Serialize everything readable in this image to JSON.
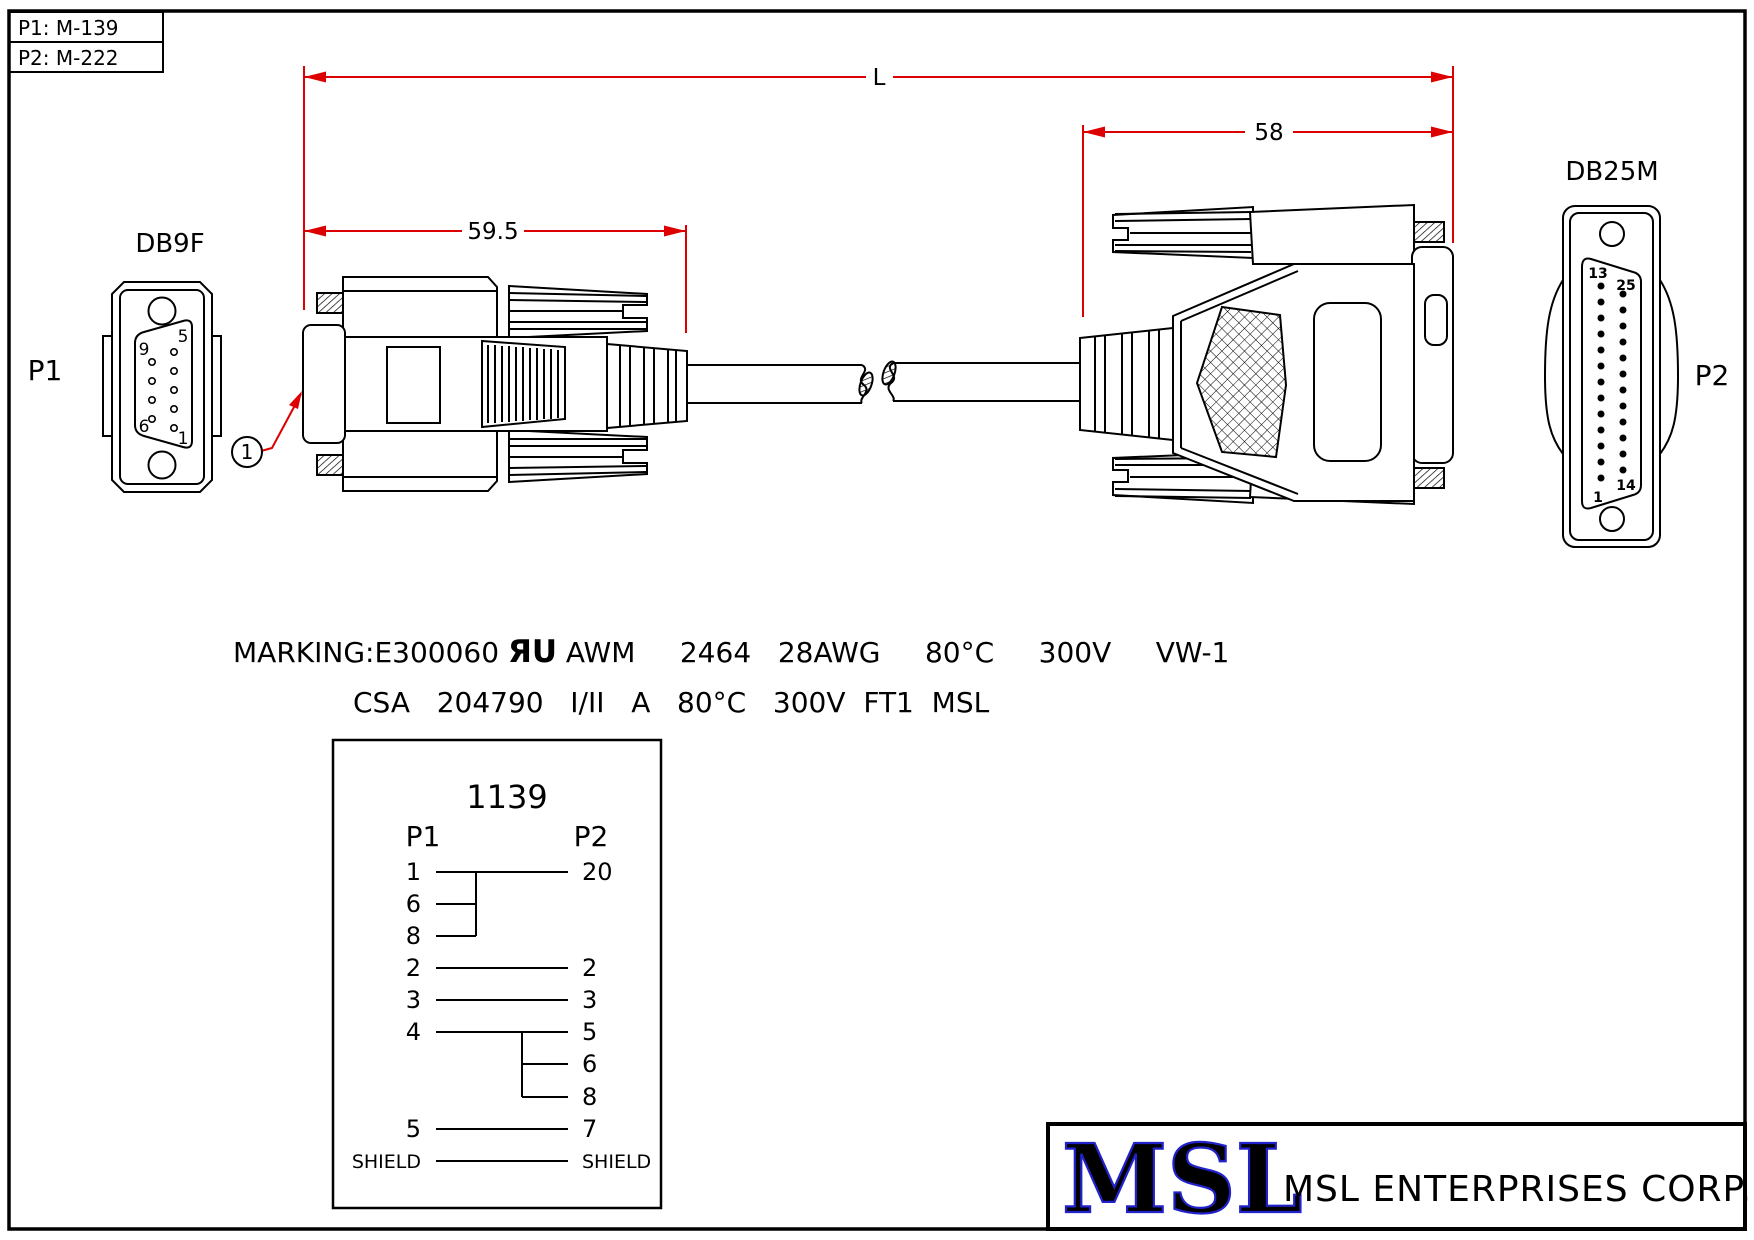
{
  "colors": {
    "ink": "#000000",
    "dimension_red": "#dd0000",
    "logo_blue": "#2222cc",
    "paper": "#ffffff"
  },
  "ref_box": {
    "p1": "P1: M-139",
    "p2": "P2: M-222"
  },
  "dimensions": {
    "overall_label": "L",
    "right_length": "58",
    "left_length": "59.5"
  },
  "balloon": {
    "id": "1"
  },
  "db9f": {
    "title": "DB9F",
    "designator": "P1",
    "pin_top_left": "9",
    "pin_top_right": "5",
    "pin_bottom_left": "6",
    "pin_bottom_right": "1"
  },
  "db25m": {
    "title": "DB25M",
    "designator": "P2",
    "pin_top_left": "13",
    "pin_top_right": "25",
    "pin_bottom_left": "1",
    "pin_bottom_right": "14"
  },
  "marking": {
    "prefix": "MARKING:E300060 ",
    "ul_mark": "ЯU",
    "line1_rest": " AWM     2464   28AWG     80°C     300V     VW-1",
    "line2": "CSA   204790   I/II   A   80°C   300V  FT1  MSL"
  },
  "wiring": {
    "part_number": "1139",
    "header_p1": "P1",
    "header_p2": "P2",
    "rows": [
      {
        "p1": "1",
        "p2": "20"
      },
      {
        "p1": "6",
        "p2": ""
      },
      {
        "p1": "8",
        "p2": ""
      },
      {
        "p1": "2",
        "p2": "2"
      },
      {
        "p1": "3",
        "p2": "3"
      },
      {
        "p1": "4",
        "p2": "5"
      },
      {
        "p1": "",
        "p2": "6"
      },
      {
        "p1": "",
        "p2": "8"
      },
      {
        "p1": "5",
        "p2": "7"
      },
      {
        "p1": "SHIELD",
        "p2": "SHIELD"
      }
    ]
  },
  "title_block": {
    "logo": "MSL",
    "company": "MSL ENTERPRISES CORP."
  }
}
